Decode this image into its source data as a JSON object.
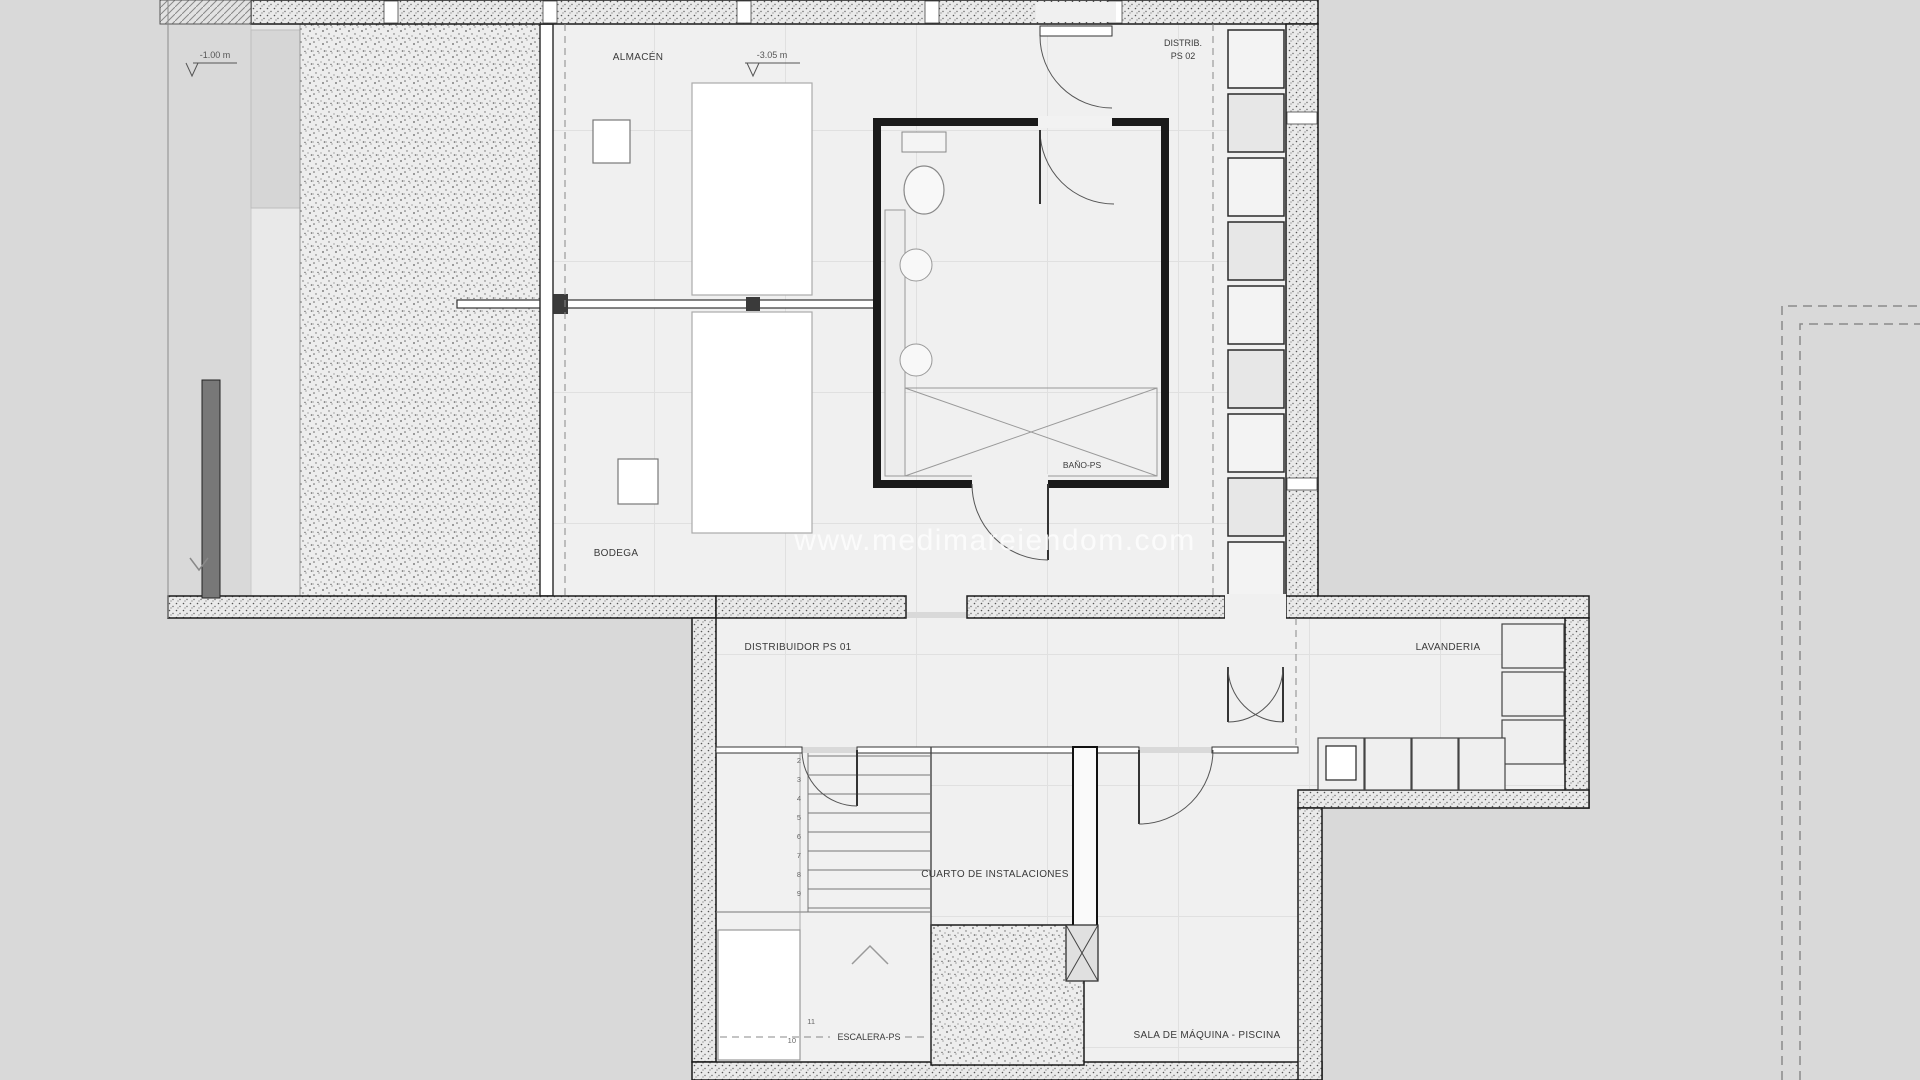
{
  "watermark": "www.medimareiendom.com",
  "levels": {
    "upper_left": "-1.00 m",
    "almacen": "-3.05 m"
  },
  "labels": {
    "almacen": "ALMACÉN",
    "distrib_ps02_l1": "DISTRIB.",
    "distrib_ps02_l2": "PS 02",
    "bano_ps": "BAÑO-PS",
    "bodega": "BODEGA",
    "distribuidor_ps01": "DISTRIBUIDOR PS 01",
    "lavanderia": "LAVANDERIA",
    "cuarto_instalaciones": "CUARTO DE INSTALACIONES",
    "sala_maquina_piscina": "SALA DE MÁQUINA - PISCINA",
    "escalera_ps": "ESCALERA-PS"
  },
  "stairs": {
    "numbers": [
      "2",
      "3",
      "4",
      "5",
      "6",
      "7",
      "8",
      "9",
      "10",
      "11"
    ]
  },
  "colors": {
    "background": "#d9d9d9",
    "floor": "#f0f0f0",
    "wall_edge": "#1a1a1a",
    "thin_line": "#777777",
    "text": "#3a3a3a",
    "watermark": "#ffffff"
  }
}
